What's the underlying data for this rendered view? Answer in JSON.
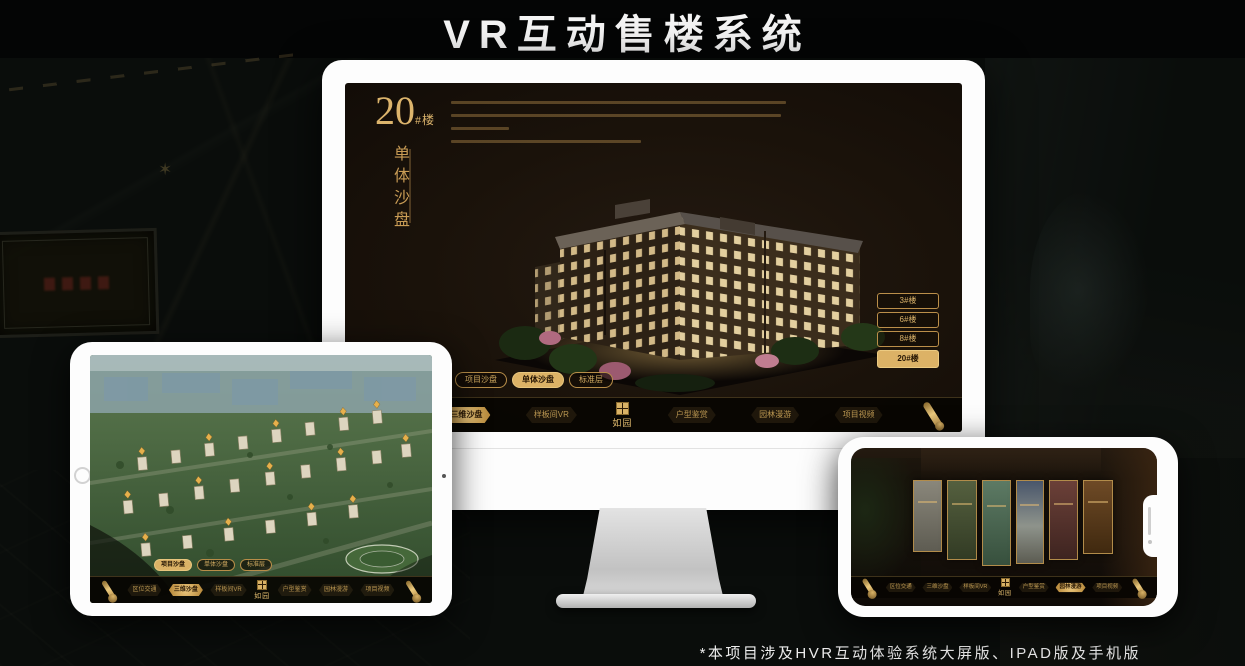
{
  "header": {
    "title": "VR互动售楼系统"
  },
  "footer": {
    "note": "*本项目涉及HVR互动体验系统大屏版、IPAD版及手机版"
  },
  "colors": {
    "gold": "#c99c55",
    "gold_bright": "#e3b96d",
    "selected_fill": "#dcb266",
    "screen_bg": "#1a120a"
  },
  "monitor_ui": {
    "block_number": "20",
    "block_suffix": "#楼",
    "block_title": "单体沙盘",
    "floor_buttons": [
      {
        "label": "3#楼",
        "selected": false
      },
      {
        "label": "6#楼",
        "selected": false
      },
      {
        "label": "8#楼",
        "selected": false
      },
      {
        "label": "20#楼",
        "selected": true
      }
    ],
    "tabs": [
      {
        "label": "项目沙盘",
        "selected": false
      },
      {
        "label": "单体沙盘",
        "selected": true
      },
      {
        "label": "标准层",
        "selected": false
      }
    ],
    "nav": {
      "logo": "如园",
      "items": [
        {
          "label": "区位交通",
          "selected": false
        },
        {
          "label": "三维沙盘",
          "selected": true
        },
        {
          "label": "样板间VR",
          "selected": false
        },
        {
          "label": "户型鉴赏",
          "selected": false
        },
        {
          "label": "园林漫游",
          "selected": false
        },
        {
          "label": "项目视频",
          "selected": false
        }
      ]
    }
  },
  "tablet_ui": {
    "tabs": [
      {
        "label": "项目沙盘",
        "selected": true
      },
      {
        "label": "单体沙盘",
        "selected": false
      },
      {
        "label": "标准层",
        "selected": false
      }
    ],
    "nav": {
      "logo": "如园",
      "items": [
        {
          "label": "区位交通",
          "selected": false
        },
        {
          "label": "三维沙盘",
          "selected": true
        },
        {
          "label": "样板间VR",
          "selected": false
        },
        {
          "label": "户型鉴赏",
          "selected": false
        },
        {
          "label": "园林漫游",
          "selected": false
        },
        {
          "label": "项目视频",
          "selected": false
        }
      ]
    }
  },
  "phone_ui": {
    "nav": {
      "logo": "如园",
      "items": [
        {
          "label": "区位交通",
          "selected": false
        },
        {
          "label": "三维沙盘",
          "selected": false
        },
        {
          "label": "样板间VR",
          "selected": false
        },
        {
          "label": "户型鉴赏",
          "selected": false
        },
        {
          "label": "园林漫游",
          "selected": true
        },
        {
          "label": "项目视频",
          "selected": false
        }
      ]
    }
  }
}
